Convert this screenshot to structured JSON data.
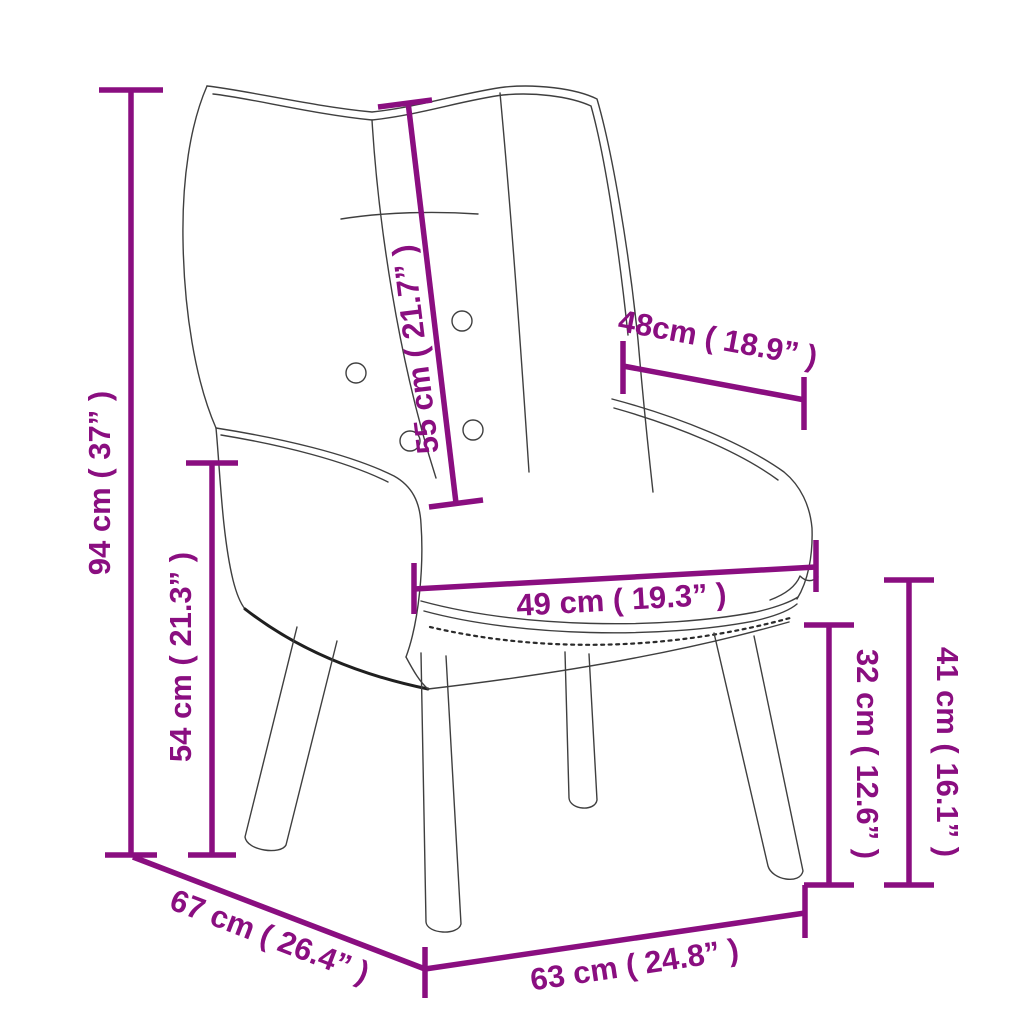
{
  "diagram": {
    "subject": "wingback relaxing chair dimension drawing",
    "accent_color": "#8a0e80",
    "outline_color": "#3f3f3f",
    "background_color": "#ffffff"
  },
  "dimensions": [
    {
      "id": "overall-height",
      "value_cm": 94,
      "label": "94 cm ( 37” )"
    },
    {
      "id": "back-to-seat",
      "value_cm": 54,
      "label": "54 cm ( 21.3” )"
    },
    {
      "id": "backrest-length",
      "value_cm": 55,
      "label": "55 cm ( 21.7” )"
    },
    {
      "id": "armrest-depth",
      "value_cm": 48,
      "label": "48cm ( 18.9” )"
    },
    {
      "id": "seat-width",
      "value_cm": 49,
      "label": "49 cm ( 19.3” )"
    },
    {
      "id": "seat-height",
      "value_cm": 32,
      "label": "32 cm ( 12.6” )"
    },
    {
      "id": "armrest-height",
      "value_cm": 41,
      "label": "41 cm ( 16.1” )"
    },
    {
      "id": "overall-depth",
      "value_cm": 67,
      "label": "67 cm ( 26.4” )"
    },
    {
      "id": "overall-width",
      "value_cm": 63,
      "label": "63 cm ( 24.8” )"
    }
  ]
}
